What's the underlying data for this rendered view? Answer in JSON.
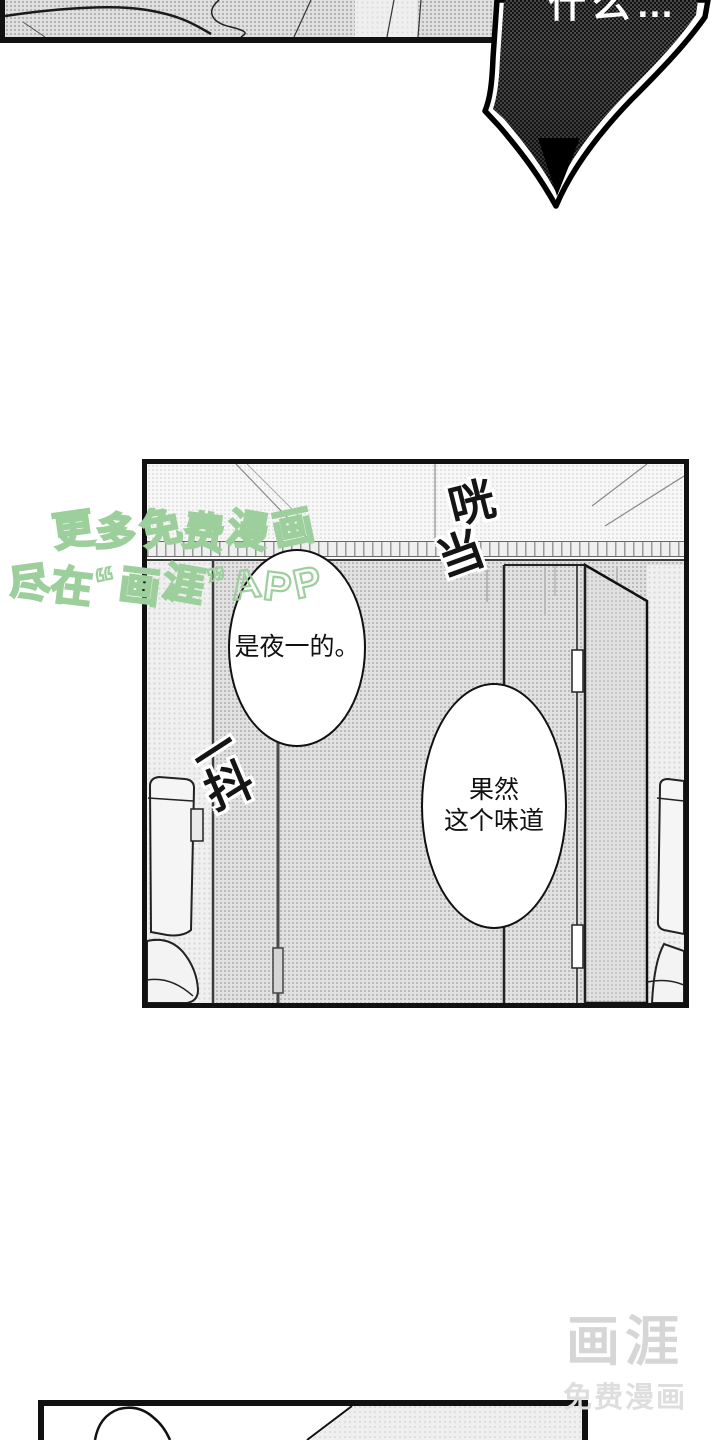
{
  "page": {
    "background": "#ffffff",
    "ink": "#111111"
  },
  "top_panel": {
    "description_fill": "gray-halftone-cloth"
  },
  "dark_bubble": {
    "partial_text": "什么…",
    "fill_color": "#2d2d2d",
    "outline_color": "#000000"
  },
  "main_panel": {
    "sfx_clatter": "咣当",
    "sfx_shake": "一抖",
    "bubbles": [
      {
        "text": "是夜一的。"
      },
      {
        "line1": "果然",
        "line2": "这个味道"
      }
    ]
  },
  "watermark": {
    "line1": "更多免费漫画",
    "line2": "尽在“画涯”APP",
    "color": "#9ccf9c"
  },
  "logo": {
    "title": "画涯",
    "subtitle": "免费漫画",
    "color": "#d6d6d6"
  },
  "bottom_panel": {}
}
